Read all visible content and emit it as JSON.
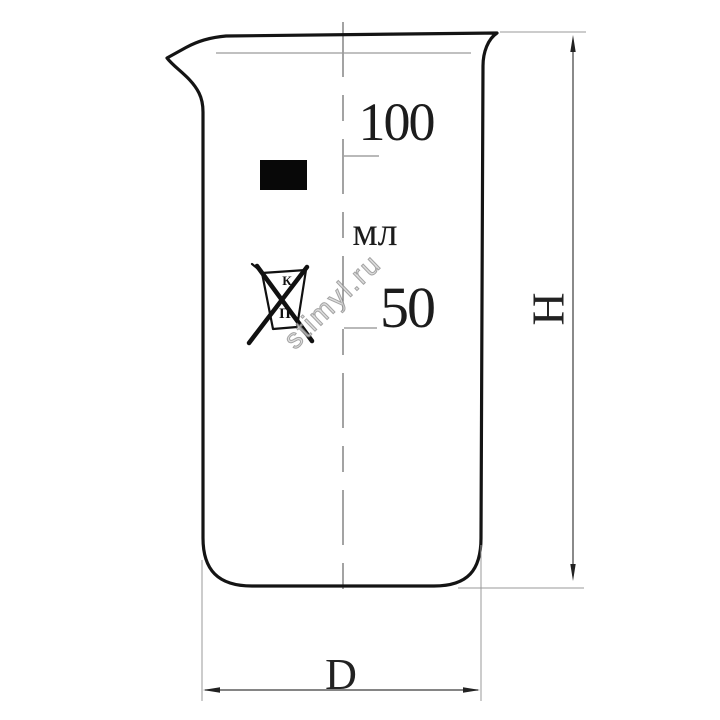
{
  "drawing": {
    "kind": "beaker-technical-drawing",
    "labels": {
      "graduation_top": "100",
      "unit": "мл",
      "graduation_mid": "50",
      "height_dim": "H",
      "diameter_dim": "D"
    },
    "logo": {
      "top_letter": "К",
      "bottom_letter": "П"
    },
    "watermark": "stimyl.ru",
    "colors": {
      "background": "#ffffff",
      "outline": "#141414",
      "thin_line": "#9a9a9a",
      "center_line": "#666666",
      "dimension_line": "#3c3c3c",
      "fill_mark": "#080808",
      "watermark": "#b5b5b5"
    }
  }
}
